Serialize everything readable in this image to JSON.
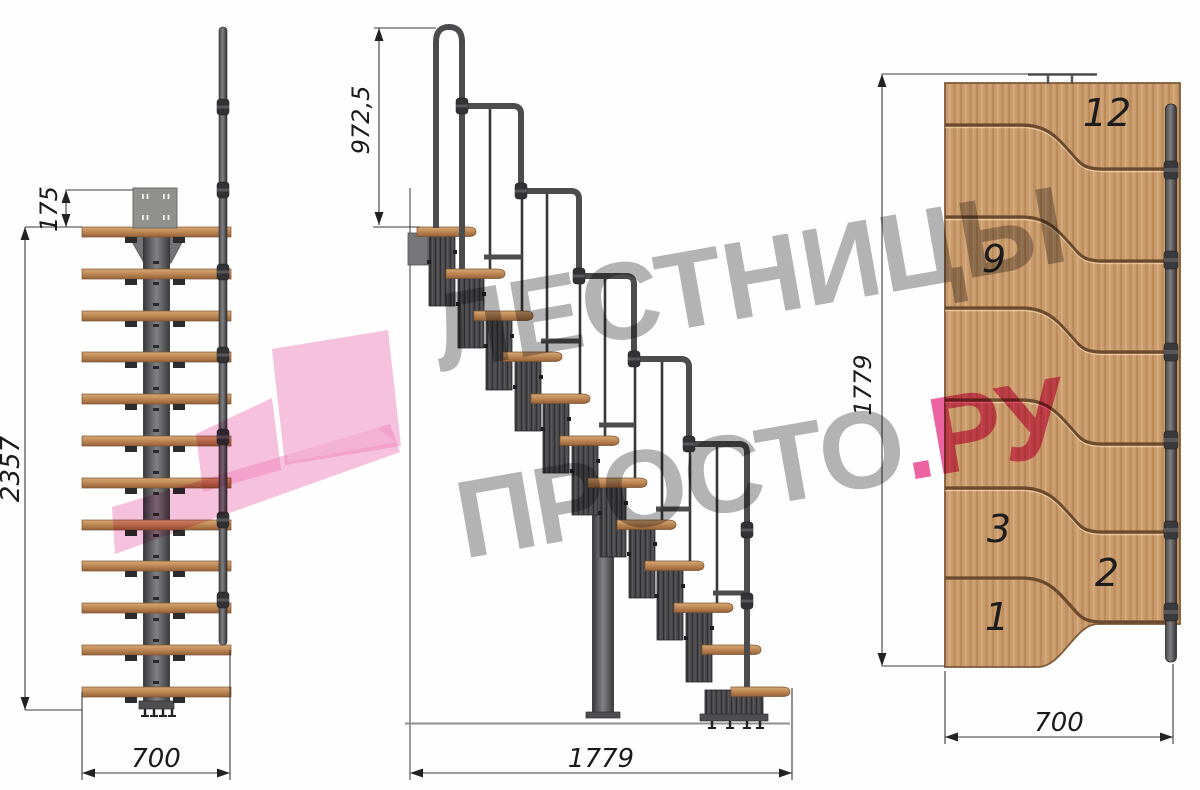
{
  "drawing_title": "modular-staircase-technical-drawing",
  "dimensions": {
    "front": {
      "top_offset": "175",
      "height": "2357",
      "width": "700"
    },
    "side": {
      "rail_height": "972,5",
      "length": "1779"
    },
    "plan": {
      "length": "1779",
      "width": "700"
    }
  },
  "plan_step_numbers": {
    "s12": "12",
    "s9": "9",
    "s3": "3",
    "s2": "2",
    "s1": "1"
  },
  "steps_count": 12,
  "watermark": {
    "line1": "ЛЕСТНИЦЫ",
    "line2_gray": "ПРОСТО",
    "line2_dot": ".",
    "line2_pink": "РУ",
    "gray_color": "#8c8c8c",
    "pink_color": "#e94891",
    "logo_pink": "#ef86bb"
  },
  "colors": {
    "wood_light": "#d4a271",
    "wood_dark": "#9a6336",
    "steel_dark": "#3f3f41",
    "steel_mid": "#77777a",
    "groove_brown": "#6a4a2c",
    "dim_line": "#3a3a3a"
  }
}
